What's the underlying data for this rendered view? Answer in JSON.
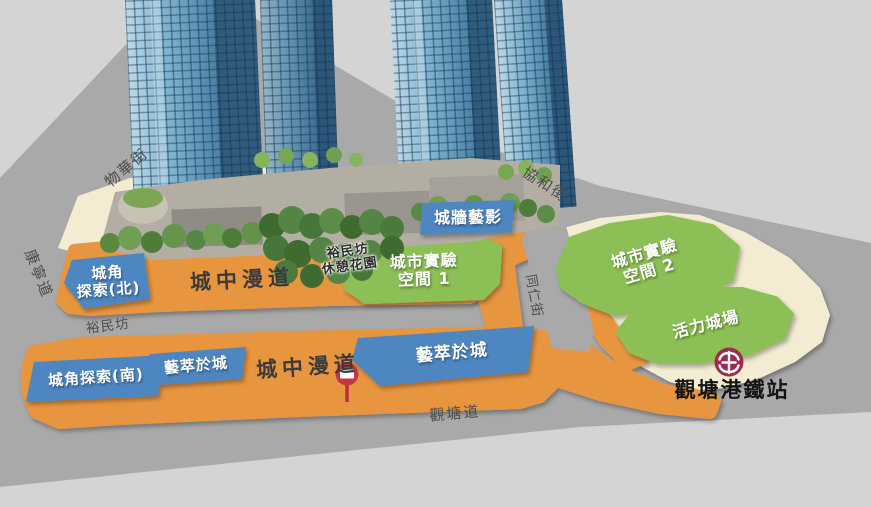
{
  "streets": {
    "mut_wah_street": "物華街",
    "hong_ning_road": "康寧道",
    "hip_wo_street": "協和街",
    "tung_yan_street": "同仁街",
    "yue_man_fong": "裕民坊",
    "kwun_tong_road": "觀塘道"
  },
  "walkway": {
    "north_label": "城中漫道",
    "south_label": "城中漫道"
  },
  "park": {
    "line1": "裕民坊",
    "line2": "休憩花園"
  },
  "zones": {
    "wall_art_label": "城牆藝影",
    "corner_north_line1": "城角",
    "corner_north_line2": "探索(北)",
    "corner_south_label": "城角探索(南)",
    "art_in_city_west_label": "藝萃於城",
    "art_in_city_east_label": "藝萃於城",
    "urban_lab1_line1": "城市實驗",
    "urban_lab1_line2": "空間 1",
    "urban_lab2_line1": "城市實驗",
    "urban_lab2_line2": "空間 2",
    "vibrant_plaza_label": "活力城場"
  },
  "station": {
    "name": "觀塘港鐵站"
  },
  "colors": {
    "background_gray": "#D4D4D4",
    "street_gray": "#A9A9A9",
    "walkway_orange": "#E8953F",
    "cream": "#F3ECD2",
    "zone_green": "#8CBF55",
    "label_blue": "#4D86C0",
    "mtr_red": "#9B2C4D",
    "sign_red": "#C53642"
  }
}
